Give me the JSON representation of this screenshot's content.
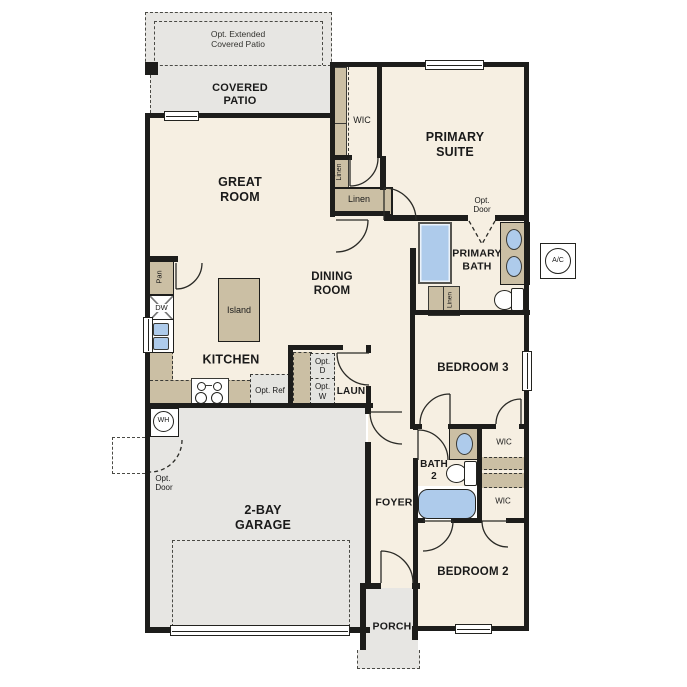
{
  "colors": {
    "wall": "#1d1d1b",
    "floor": "#f6efe2",
    "outdoor": "#e7e6e3",
    "cabinet": "#cbbfa4",
    "water_fixture": "#aecbeb",
    "optional_fill": "#e4e4e0"
  },
  "patio": {
    "opt_extended_label": "Opt. Extended\nCovered Patio",
    "covered_label": "COVERED\nPATIO"
  },
  "rooms": {
    "great_room": "GREAT\nROOM",
    "dining_room": "DINING\nROOM",
    "kitchen": "KITCHEN",
    "primary_suite": "PRIMARY\nSUITE",
    "primary_bath": "PRIMARY\nBATH",
    "bedroom3": "BEDROOM 3",
    "bedroom2": "BEDROOM 2",
    "bath2": "BATH\n2",
    "laundry": "LAUN",
    "foyer": "FOYER",
    "garage": "2-BAY\nGARAGE",
    "porch": "PORCH"
  },
  "closets": {
    "wic_primary": "WIC",
    "wic_bedroom3": "WIC",
    "wic_bedroom2": "WIC",
    "linen_hall": "Linen",
    "linen_wic": "Linen",
    "linen_bath": "Linen",
    "pantry": "Pan"
  },
  "fixtures": {
    "island": "Island",
    "dishwasher": "DW",
    "water_heater": "WH",
    "ac_unit": "A/C"
  },
  "optionals": {
    "opt_ref": "Opt.\nRef",
    "opt_dryer": "Opt.\nD",
    "opt_washer": "Opt.\nW",
    "opt_door_suite": "Opt.\nDoor",
    "opt_door_garage": "Opt.\nDoor"
  }
}
